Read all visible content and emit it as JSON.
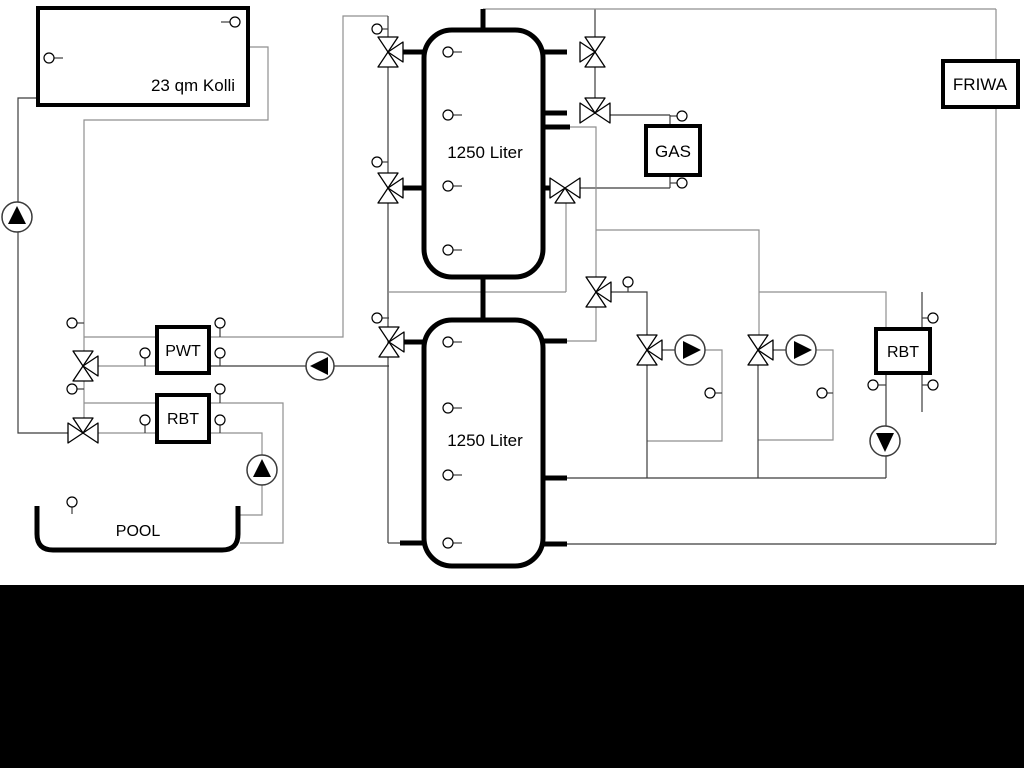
{
  "diagram_title": "heating-system-hydraulic-schematic",
  "labels": {
    "collector": "23 qm Kolli",
    "tank_top": "1250 Liter",
    "tank_bottom": "1250 Liter",
    "gas": "GAS",
    "friwa": "FRIWA",
    "pwt": "PWT",
    "rbt_left": "RBT",
    "rbt_right": "RBT",
    "pool": "POOL"
  },
  "colors": {
    "background": "#ffffff",
    "pipe_thick": "#000000",
    "line_dark": "#3c3c3c",
    "line_gray": "#8f8f8f",
    "bottom_bar": "#000000"
  },
  "icons": {
    "pump": "circle-with-solid-triangle",
    "three_way_valve": "three-triangle-bowtie",
    "sensor": "small-circle-with-stem"
  }
}
